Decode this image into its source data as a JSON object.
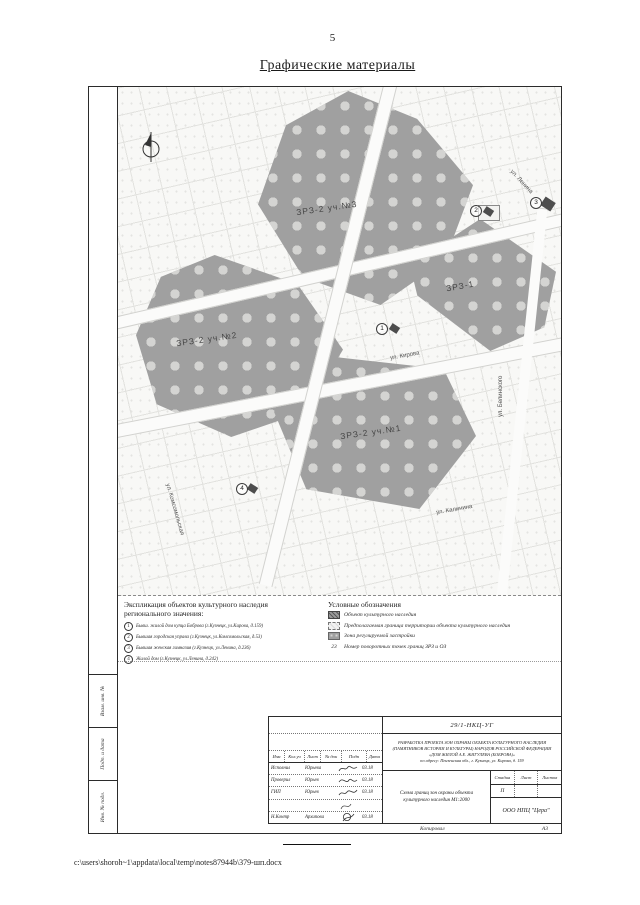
{
  "page": {
    "number": "5",
    "title": "Графические материалы"
  },
  "map": {
    "zone_labels": {
      "zrz2_u3": "ЗРЗ-2 уч.№3",
      "zrz1": "ЗРЗ-1",
      "zrz2_u2": "ЗРЗ-2 уч.№2",
      "zrz2_u1": "ЗРЗ-2 уч.№1"
    },
    "street_labels": {
      "kirova": "ул. Кирова",
      "lenina": "ул. Ленина",
      "belinskogo": "ул. Белинского",
      "kalinina": "ул. Калинина",
      "komsomolskaya": "ул. Комсомольская"
    },
    "markers": {
      "m1": "1",
      "m2": "2",
      "m3": "3",
      "m4": "4"
    }
  },
  "explication": {
    "title": "Экспликация объектов культурного наследия регионального значения:",
    "items": [
      {
        "num": "1",
        "text": "Бывш. жилой дом купца Боброва (г.Кузнецк, ул.Кирова, д.159)"
      },
      {
        "num": "2",
        "text": "Бывшая городская управа (г.Кузнецк, ул.Комсомольская, д.53)"
      },
      {
        "num": "3",
        "text": "Бывшая женская гимназия (г.Кузнецк, ул.Ленина, д.236)"
      },
      {
        "num": "4",
        "text": "Жилой дом (г.Кузнецк, ул.Ленина, д.242)"
      }
    ]
  },
  "legend": {
    "title": "Условные обозначения",
    "items": [
      {
        "text": "Объект культурного наследия"
      },
      {
        "text": "Предполагаемая граница территории объекта культурного наследия"
      },
      {
        "text": "Зона регулируемой застройки"
      },
      {
        "symbol_text": "23",
        "text": "Номер поворотных точек границ ЗРЗ и ОЗ"
      }
    ]
  },
  "stamp": {
    "doc_number": "29/1-НКЦ-УГ",
    "project_lines": [
      "РАЗРАБОТКА ПРОЕКТА ЗОН ОХРАНЫ ОБЪЕКТА КУЛЬТУРНОГО НАСЛЕДИЯ",
      "(ПАМЯТНИКОВ ИСТОРИИ И КУЛЬТУРЫ) НАРОДОВ РОССИЙСКОЙ ФЕДЕРАЦИИ",
      "«ДОМ ЖИЛОЙ А.Е. ЖИГУЛЕВА (БОБРОВА)»",
      "по адресу: Пензенская обл., г. Кузнецк, ул. Кирова, д. 159"
    ],
    "header_cols": [
      "Изм",
      "Кол.уч",
      "Лист",
      "№ док",
      "Подп",
      "Дата"
    ],
    "rows": [
      {
        "role": "Исполнил",
        "name": "Юрьева",
        "date": "03.18"
      },
      {
        "role": "Проверил",
        "name": "Юрьев",
        "date": "03.18"
      },
      {
        "role": "ГИП",
        "name": "Юрьев",
        "date": "03.18"
      },
      {
        "role": "Н.Контр",
        "name": "Архипова",
        "date": "03.18"
      }
    ],
    "sheet_title_line1": "Схема границ зон охраны объекта",
    "sheet_title_line2": "культурного наследия М1:2000",
    "stage_label": "Стадия",
    "list_label": "Лист",
    "listov_label": "Листов",
    "stage_value": "П",
    "company": "ООО НПЦ \"Цера\"",
    "copied_label": "Копировал",
    "format_label": "А3"
  },
  "side_strips": [
    "Взам. инв. №",
    "Подп. и дата",
    "Инв. № подл."
  ],
  "footer": {
    "file_path": "c:\\users\\shoroh~1\\appdata\\local\\temp\\notes87944b\\379-шп.docx"
  }
}
